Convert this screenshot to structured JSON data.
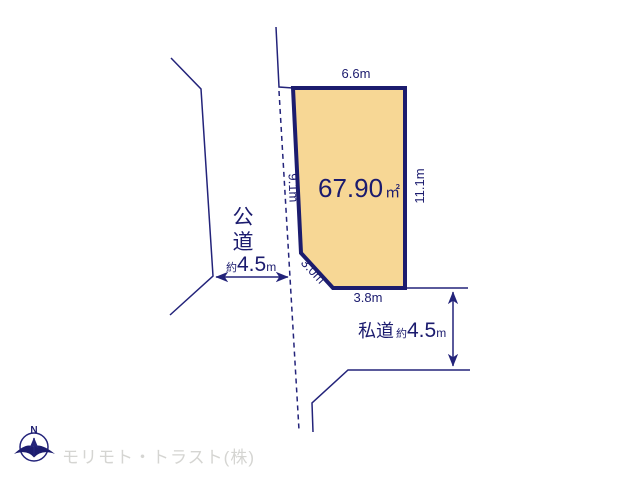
{
  "plot": {
    "area_value": "67.90",
    "area_unit": "㎡",
    "dimensions": {
      "top": "6.6m",
      "right": "11.1m",
      "left": "9.1m",
      "diagonal": "3.0m",
      "bottom": "3.8m"
    },
    "fill_color": "#f7d795",
    "border_color": "#1c1c6e"
  },
  "roads": {
    "public": {
      "chars": [
        "公",
        "道"
      ],
      "width_approx": "約",
      "width_value": "4.5",
      "width_unit": "m"
    },
    "private": {
      "label": "私道",
      "width_approx": "約",
      "width_value": "4.5",
      "width_unit": "m"
    }
  },
  "compass": {
    "north_label": "N"
  },
  "footer": {
    "company": "モリモト・トラスト(株)"
  },
  "colors": {
    "line_navy": "#23237a",
    "text_navy": "#1b1b6e",
    "plot_fill": "#f7d795",
    "plot_border": "#1c1c6e",
    "company_gray": "#d5d5d2"
  }
}
